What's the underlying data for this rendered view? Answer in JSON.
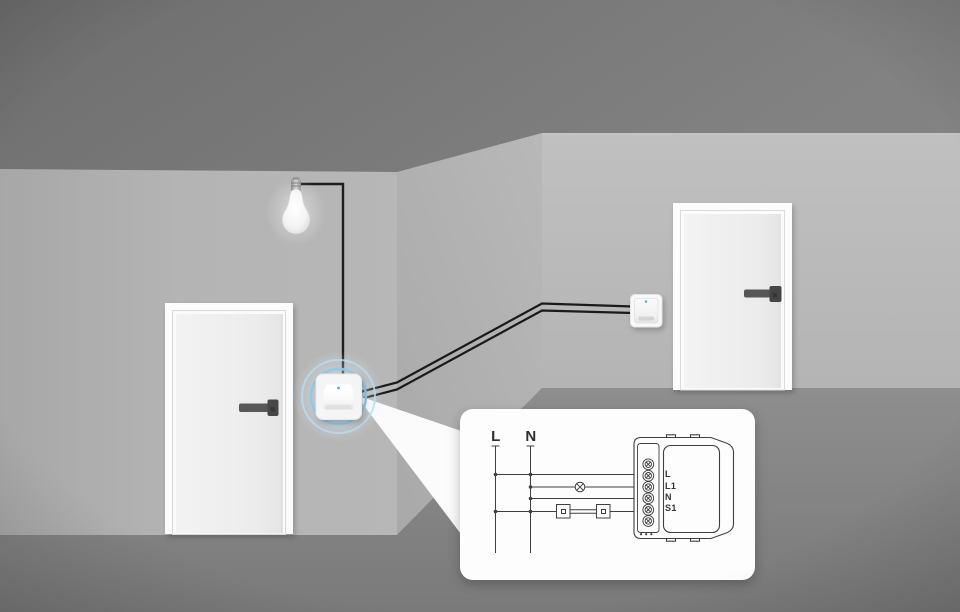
{
  "diagram": {
    "bus_labels": {
      "live": "L",
      "neutral": "N"
    },
    "terminal_labels": [
      "L",
      "L1",
      "N",
      "S1"
    ]
  },
  "icons": {
    "lamp_symbol": "circle-with-x",
    "switch_symbol": "square-in-square",
    "status_led": "blue-dot"
  },
  "colors": {
    "highlight_blue": "#8fc8ea",
    "wire_black": "#1a1a1a",
    "upper_wall_gray": "#828282",
    "wall_gray": "#b5b5b5",
    "floor_gray": "#868686",
    "callout_white": "#fdfdfd",
    "diagram_line": "#3f3f3f",
    "led_blue": "#58abe2"
  }
}
